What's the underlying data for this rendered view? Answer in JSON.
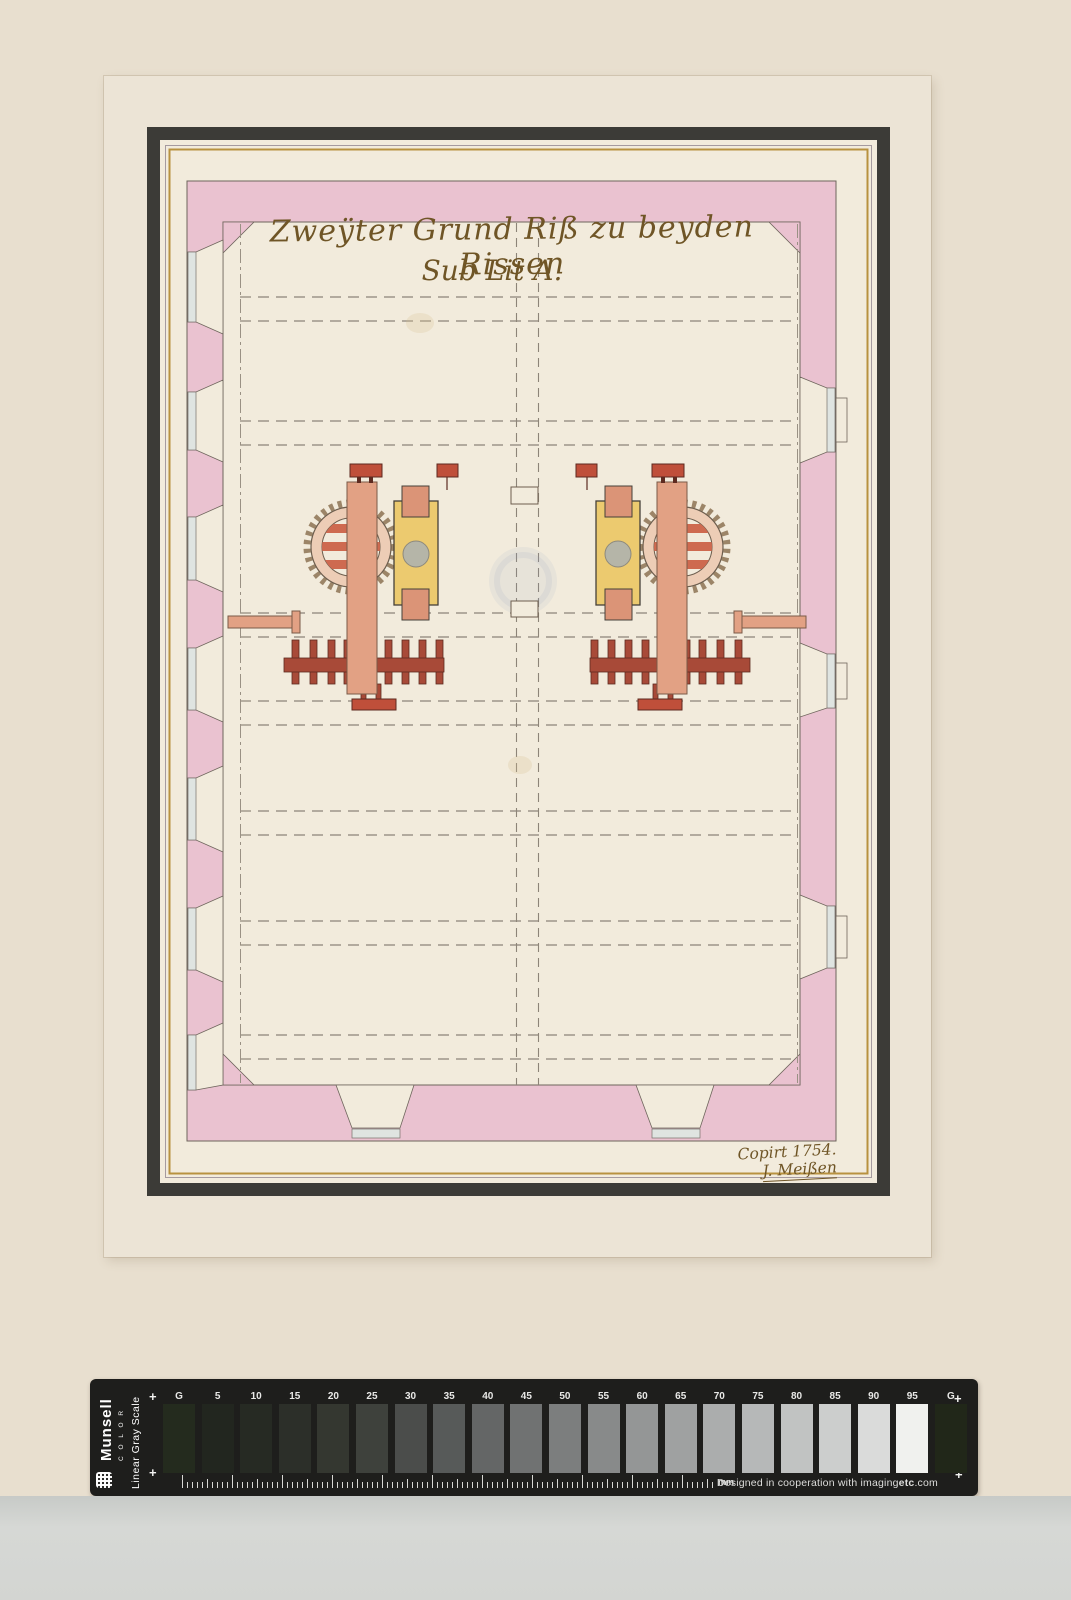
{
  "drawing": {
    "title_line1": "Zweÿter Grund Riß zu beyden Rissen",
    "title_line2": "Sub Lit A.",
    "signature_line1": "Copirt 1754.",
    "signature_line2": "J. Meißen"
  },
  "colors": {
    "mat": "#e8dfcf",
    "sheet": "#ece4d6",
    "paper": "#f2ebdc",
    "frame": "#3c3b37",
    "gold": "#b8923f",
    "ink": "#6f5526",
    "wall_pink": "#eac2d0",
    "machine_salmon": "#e2a184",
    "machine_yellow": "#ecca6f",
    "machine_red": "#bf4f3a",
    "stamp_red": "#a84a38",
    "millstone_gray": "#b5b5a8",
    "bar_black": "#1e1e1c",
    "scanner_gray": "#d3d5d2"
  },
  "calibration_bar": {
    "brand": "Munsell",
    "brand_sub": "C O L O R",
    "scale_name": "Linear Gray Scale",
    "unit_label": "mm",
    "plus_mark": "+",
    "credit_prefix": "Designed in cooperation with imaging",
    "credit_bold": "etc",
    "credit_suffix": ".com",
    "patches": [
      {
        "label": "G",
        "hex": "#242b1e"
      },
      {
        "label": "5",
        "hex": "#22261f"
      },
      {
        "label": "10",
        "hex": "#262a23"
      },
      {
        "label": "15",
        "hex": "#2c2f29"
      },
      {
        "label": "20",
        "hex": "#343730"
      },
      {
        "label": "25",
        "hex": "#3e413c"
      },
      {
        "label": "30",
        "hex": "#4b4d4b"
      },
      {
        "label": "35",
        "hex": "#575a59"
      },
      {
        "label": "40",
        "hex": "#646666"
      },
      {
        "label": "45",
        "hex": "#707272"
      },
      {
        "label": "50",
        "hex": "#7c7e7e"
      },
      {
        "label": "55",
        "hex": "#888a8a"
      },
      {
        "label": "60",
        "hex": "#949696"
      },
      {
        "label": "65",
        "hex": "#9fa1a1"
      },
      {
        "label": "70",
        "hex": "#abadad"
      },
      {
        "label": "75",
        "hex": "#b6b8b8"
      },
      {
        "label": "80",
        "hex": "#c1c3c2"
      },
      {
        "label": "85",
        "hex": "#cccecd"
      },
      {
        "label": "90",
        "hex": "#dadbda"
      },
      {
        "label": "95",
        "hex": "#f0f1ee"
      },
      {
        "label": "G",
        "hex": "#212719"
      }
    ]
  }
}
